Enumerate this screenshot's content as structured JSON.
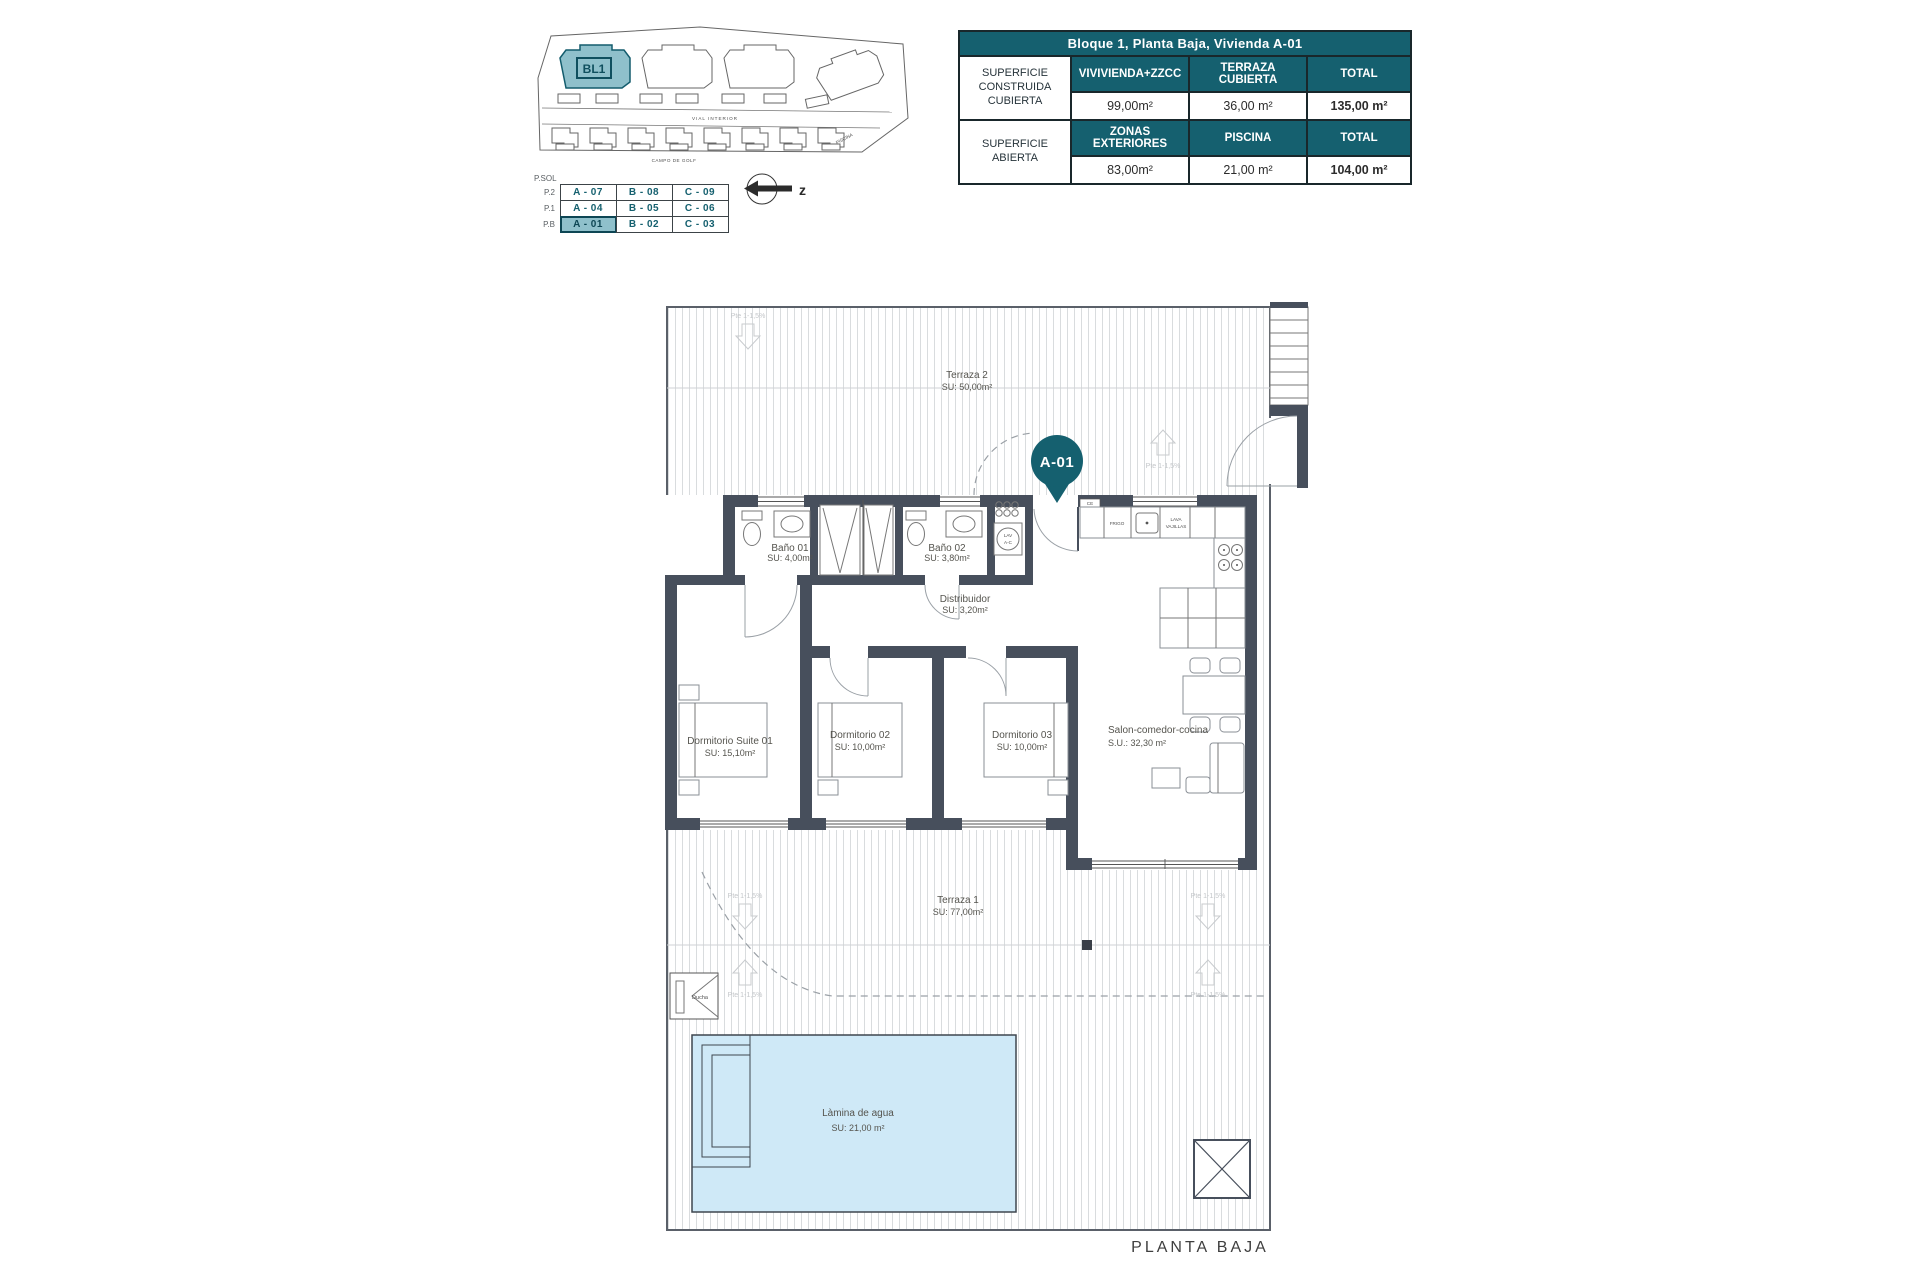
{
  "window": {
    "plan_title": "PLANTA BAJA"
  },
  "site_plan": {
    "block_label": "BL1",
    "road_label": "VIAL INTERIOR",
    "golf_label": "CAMPO DE GOLF",
    "pool_label": "PISCINA",
    "north_label": "z"
  },
  "unit_matrix": {
    "header": "P.SOL",
    "levels": [
      "P.2",
      "P.1",
      "P.B"
    ],
    "rows": [
      [
        "A - 07",
        "B - 08",
        "C - 09"
      ],
      [
        "A - 04",
        "B - 05",
        "C - 06"
      ],
      [
        "A - 01",
        "B - 02",
        "C - 03"
      ]
    ],
    "highlighted_unit": "A - 01"
  },
  "summary_table": {
    "title": "Bloque 1, Planta Baja, Vivienda A-01",
    "groups": [
      {
        "label": "SUPERFICIE CONSTRUIDA CUBIERTA",
        "col1": "VIVIVIENDA+ZZCC",
        "col2": "TERRAZA CUBIERTA",
        "col3": "TOTAL",
        "val1": "99,00m²",
        "val2": "36,00 m²",
        "val3": "135,00 m²"
      },
      {
        "label": "SUPERFICIE ABIERTA",
        "col1": "ZONAS EXTERIORES",
        "col2": "PISCINA",
        "col3": "TOTAL",
        "val1": "83,00m²",
        "val2": "21,00 m²",
        "val3": "104,00 m²"
      }
    ]
  },
  "floor_plan": {
    "unit_pin": "A-01",
    "slope_label": "Pte 1-1,5%",
    "rooms": [
      {
        "name": "Terraza 2",
        "area": "SU: 50,00m²"
      },
      {
        "name": "Baño 01",
        "area": "SU: 4,00m²"
      },
      {
        "name": "Baño 02",
        "area": "SU: 3,80m²"
      },
      {
        "name": "Distribuidor",
        "area": "SU: 3,20m²"
      },
      {
        "name": "Dormitorio Suite 01",
        "area": "SU: 15,10m²"
      },
      {
        "name": "Dormitorio 02",
        "area": "SU: 10,00m²"
      },
      {
        "name": "Dormitorio 03",
        "area": "SU: 10,00m²"
      },
      {
        "name": "Salon-comedor-cocina",
        "area": "S.U.: 32,30 m²"
      },
      {
        "name": "Terraza 1",
        "area": "SU: 77,00m²"
      },
      {
        "name": "Làmina de agua",
        "area": "SU: 21,00 m²"
      }
    ],
    "fixtures": {
      "fridge": "FRIGO",
      "dishwasher_1": "LAVA",
      "dishwasher_2": "VAJILLAS",
      "washer_1": "LAV",
      "washer_2": "A-C",
      "ce": "CE",
      "shower": "Ducha"
    }
  },
  "colors": {
    "teal": "#15606f",
    "highlight": "#8fc0cb",
    "wall": "#474f5c",
    "pool": "#cfe9f7"
  }
}
